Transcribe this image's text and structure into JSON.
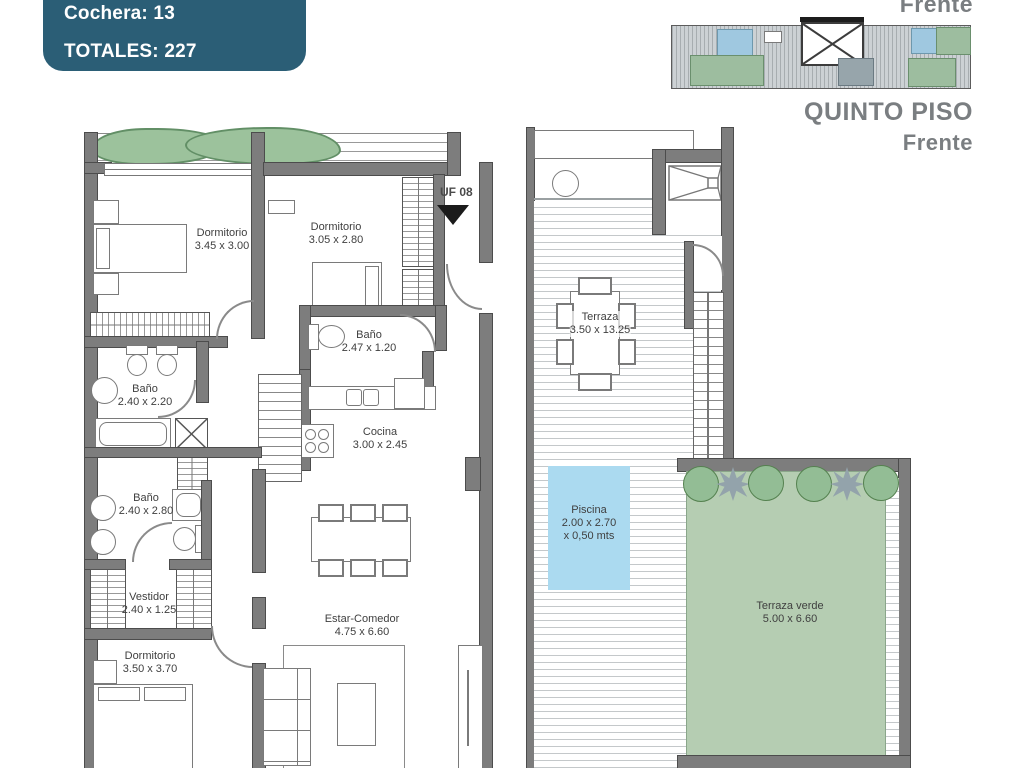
{
  "header": {
    "cochera": "Cochera: 13",
    "totales": "TOTALES: 227"
  },
  "overview": {
    "front_label_top": "Frente",
    "floor_name": "QUINTO PISO",
    "front_label_bottom": "Frente"
  },
  "unit": {
    "label": "UF 08"
  },
  "rooms": {
    "dormitorio_1": {
      "name": "Dormitorio",
      "dims": "3.45 x 3.00"
    },
    "dormitorio_2": {
      "name": "Dormitorio",
      "dims": "3.05 x 2.80"
    },
    "bano_1": {
      "name": "Baño",
      "dims": "2.47 x 1.20"
    },
    "bano_2": {
      "name": "Baño",
      "dims": "2.40 x 2.20"
    },
    "cocina": {
      "name": "Cocina",
      "dims": "3.00 x 2.45"
    },
    "bano_3": {
      "name": "Baño",
      "dims": "2.40 x 2.80"
    },
    "vestidor": {
      "name": "Vestidor",
      "dims": "2.40 x 1.25"
    },
    "dormitorio_3": {
      "name": "Dormitorio",
      "dims": "3.50 x 3.70"
    },
    "estar_comedor": {
      "name": "Estar-Comedor",
      "dims": "4.75 x 6.60"
    },
    "terraza": {
      "name": "Terraza",
      "dims": "3.50 x 13.25"
    },
    "piscina": {
      "name": "Piscina",
      "dims": "2.00 x 2.70",
      "depth": "x 0,50 mts"
    },
    "terraza_verde": {
      "name": "Terraza verde",
      "dims": "5.00 x 6.60"
    }
  },
  "colors": {
    "header_bg": "#2b5e76",
    "header_text": "#ffffff",
    "overview_text": "#7a7e81",
    "plan_text": "#3f3f3f",
    "wall_fill": "#7d7d7d",
    "pool_fill": "#abdaf0",
    "green_terrace_fill": "#b5cdb2",
    "hedge_fill": "#9cc29c"
  }
}
